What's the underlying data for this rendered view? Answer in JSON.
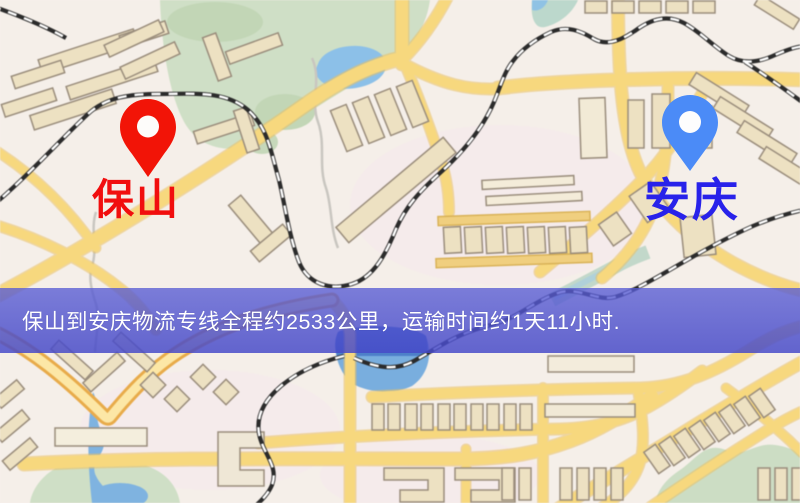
{
  "map": {
    "origin": {
      "label": "保山",
      "pin_color": "#f21407",
      "label_color": "#f10e0e"
    },
    "destination": {
      "label": "安庆",
      "pin_color": "#4b8bf7",
      "label_color": "#2822ea"
    },
    "banner": {
      "text": "保山到安庆物流专线全程约2533公里，运输时间约1天11小时.",
      "background_color": "#4d50d0",
      "text_color": "#ffffff"
    },
    "palette": {
      "road": "#f7d87e",
      "road_casing": "#e9c063",
      "highlight_road_casing": "#e8ab4a",
      "water": "#79aede",
      "pond": "#8cc0e8",
      "park": "#cfdfc6",
      "railway": "#2b2b2b",
      "building_fill": "#ede1c2",
      "building_stroke": "#9a8d7c",
      "background": "#f5efe9"
    }
  }
}
